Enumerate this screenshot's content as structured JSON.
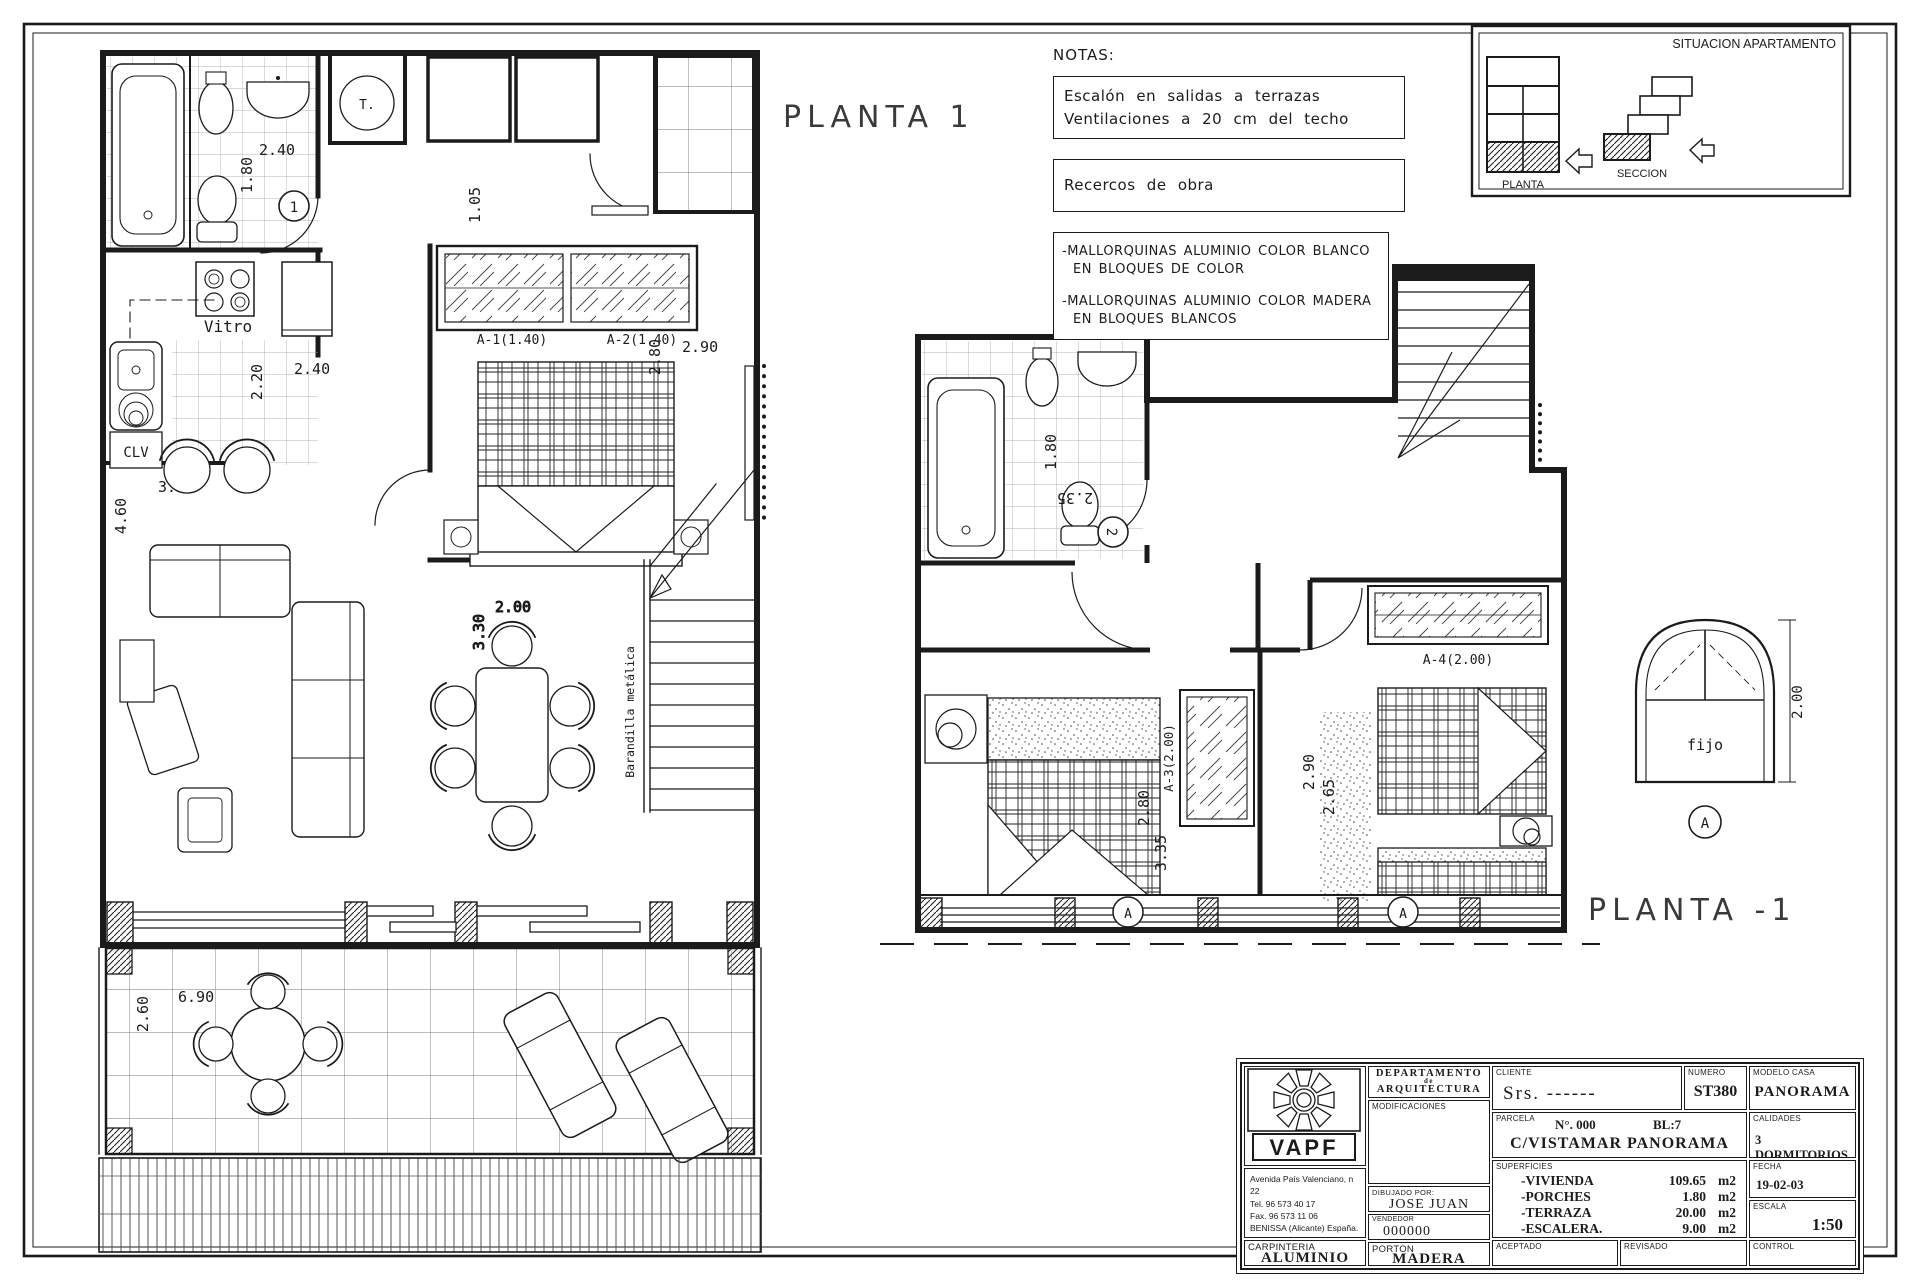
{
  "titles": {
    "plan1": "PLANTA 1",
    "plan_minus1": "PLANTA -1"
  },
  "notes": {
    "heading": "NOTAS:",
    "box1": {
      "line1": "Escalón en salidas a terrazas",
      "line2": "Ventilaciones a 20 cm del techo"
    },
    "box2": {
      "line1": "Recercos de obra"
    },
    "box3": {
      "item1_line1": "-MALLORQUINAS ALUMINIO COLOR BLANCO",
      "item1_line2": "EN BLOQUES DE COLOR",
      "item2_line1": "-MALLORQUINAS ALUMINIO COLOR MADERA",
      "item2_line2": "EN BLOQUES BLANCOS"
    }
  },
  "situacion": {
    "title": "SITUACION APARTAMENTO",
    "planta_label": "PLANTA",
    "seccion_label": "SECCION"
  },
  "plan1": {
    "dims": {
      "bath_width": "2.40",
      "bath_height": "1.80",
      "hall": "1.05",
      "kitchen_depth": "2.20",
      "kitchen_width": "2.40",
      "living_width": "3.50",
      "living_height": "4.60",
      "bedroom_depth": "2.80",
      "bedroom_width": "2.90",
      "dining_width": "2.00",
      "dining_depth": "3.30",
      "terrace_width": "6.90",
      "terrace_depth": "2.60"
    },
    "labels": {
      "room_number": "1",
      "termo": "T.",
      "vitro": "Vitro",
      "clv": "CLV",
      "window_a1": "A-1(1.40)",
      "window_a2": "A-2(1.40)",
      "stair_rail": "Barandilla metálica"
    }
  },
  "plan_minus1": {
    "dims": {
      "bath_width": "1.80",
      "bath_length": "2.35",
      "bedroom1_width": "2.80",
      "bedroom1_depth": "3.35",
      "bedroom2_width": "2.90",
      "bedroom2_depth": "2.65"
    },
    "labels": {
      "room_number": "2",
      "armario": "A-3(2.00)",
      "window_a4": "A-4(2.00)",
      "section_mark": "A"
    }
  },
  "window_detail": {
    "label": "fijo",
    "height_dim": "2.00",
    "ref_mark": "A"
  },
  "titleblock": {
    "company": "VAPF",
    "address_line1": "Avenida  País  Valenciano, n 22",
    "address_line2": "Tel.   96 573 40 17",
    "address_line3": "Fax.  96 573 11 06",
    "address_line4": "BENISSA (Alicante) España.",
    "department_line1": "DEPARTAMENTO",
    "department_line2": "de",
    "department_line3": "ARQUITECTURA",
    "modificaciones_label": "MODIFICACIONES",
    "dibujado_label": "DIBUJADO POR:",
    "dibujado_value": "JOSE JUAN",
    "vendedor_label": "VENDEDOR",
    "vendedor_value": "000000",
    "carpinteria_label": "CARPINTERIA",
    "carpinteria_value": "ALUMINIO",
    "porton_label": "PORTON",
    "porton_value": "MADERA",
    "cliente_label": "CLIENTE",
    "cliente_value": "Srs.  ------",
    "numero_label": "NUMERO",
    "numero_value": "ST380",
    "modelo_label": "MODELO  CASA",
    "modelo_value": "PANORAMA",
    "parcela_label": "PARCELA",
    "parcela_numero": "N°. 000",
    "parcela_bloque": "BL:7",
    "parcela_value": "C/VISTAMAR   PANORAMA",
    "calidades_label": "CALIDADES",
    "calidades_value": "3 DORMITORIOS",
    "superficies_label": "SUPERFICIES",
    "superficies": [
      {
        "name": "-VIVIENDA",
        "value": "109.65",
        "unit": "m2"
      },
      {
        "name": "-PORCHES",
        "value": "1.80",
        "unit": "m2"
      },
      {
        "name": "-TERRAZA",
        "value": "20.00",
        "unit": "m2"
      },
      {
        "name": "-ESCALERA.",
        "value": "9.00",
        "unit": "m2"
      }
    ],
    "fecha_label": "FECHA",
    "fecha_value": "19-02-03",
    "escala_label": "ESCALA",
    "escala_value": "1:50",
    "aceptado_label": "ACEPTADO",
    "revisado_label": "REVISADO",
    "control_label": "CONTROL"
  }
}
